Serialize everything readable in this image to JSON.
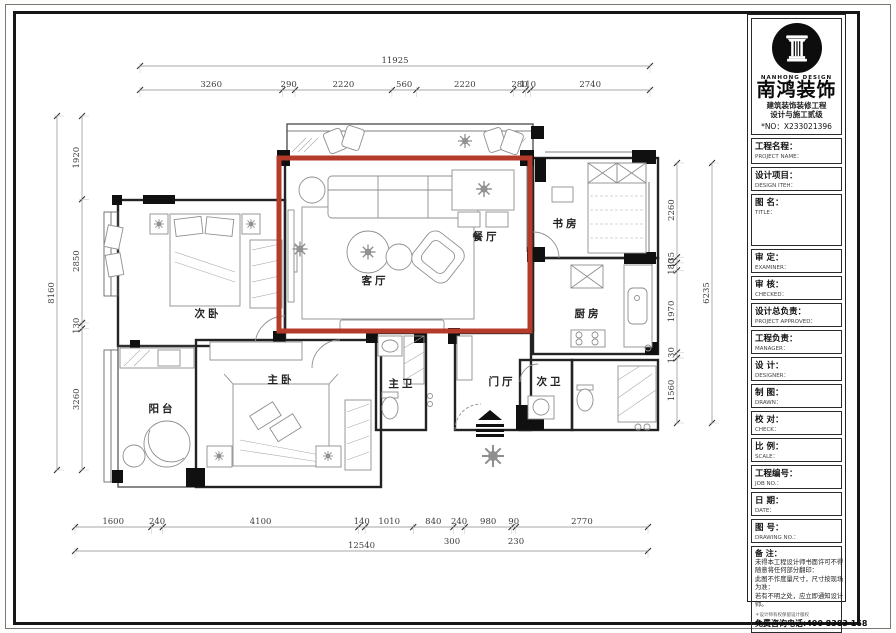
{
  "title_block": {
    "brand_en": "NANHONG DESIGN",
    "brand_cn": "南鸿装饰",
    "cert_line1": "建筑装饰装修工程",
    "cert_line2": "设计与施工贰级",
    "license_no": "*NO：X233021396",
    "fields": [
      {
        "cn": "工程名程：",
        "en": "PROJECT NAME："
      },
      {
        "cn": "设计项目：",
        "en": "DESIGN ITEH："
      },
      {
        "cn": "图 名：",
        "en": "TITLE："
      },
      {
        "cn": "审 定：",
        "en": "EXAMINER："
      },
      {
        "cn": "审 核：",
        "en": "CHECKED："
      },
      {
        "cn": "设计总负责：",
        "en": "PROJECT APPROVED："
      },
      {
        "cn": "工程负责：",
        "en": "MANAGER："
      },
      {
        "cn": "设 计：",
        "en": "DESIGNER："
      },
      {
        "cn": "制 图：",
        "en": "DRAWN："
      },
      {
        "cn": "校 对：",
        "en": "CHECK："
      },
      {
        "cn": "比 例：",
        "en": "SCALE："
      },
      {
        "cn": "工程编号：",
        "en": "JOB NO.："
      },
      {
        "cn": "日 期：",
        "en": "DATE："
      },
      {
        "cn": "图 号：",
        "en": "DRAWING NO.："
      }
    ],
    "notes_title": "备 注：",
    "notes": [
      "未得本工程设计师书面许可不得",
      "随意将任何部分翻印：",
      "此图不作度量尺寸，尺寸按现场",
      "为准：",
      "若有不明之处，应立即通知设计",
      "师。"
    ],
    "notes_small": "＊设计师有权保留设计版权",
    "phone": "免费咨询电话:400 8383 168"
  },
  "rooms": {
    "living": "客厅",
    "dining": "餐厅",
    "study": "书房",
    "bedroom2": "次卧",
    "kitchen": "厨房",
    "balcony": "阳台",
    "master": "主卧",
    "master_bath": "主卫",
    "foyer": "门厅",
    "bath2": "次卫"
  },
  "dimensions": [
    {
      "name": "dim-top-overall",
      "orient": "h",
      "at": 66,
      "from": 140,
      "to": 650,
      "values": [
        11925
      ]
    },
    {
      "name": "dim-top-segments",
      "orient": "h",
      "at": 90,
      "from": 140,
      "to": 650,
      "values": [
        3260,
        290,
        2220,
        560,
        2220,
        280,
        110,
        2740
      ]
    },
    {
      "name": "dim-left-overall",
      "orient": "v",
      "at": 57,
      "from": 116,
      "to": 470,
      "values": [
        8160
      ]
    },
    {
      "name": "dim-left-segments",
      "orient": "v",
      "at": 82,
      "from": 116,
      "to": 470,
      "values": [
        1920,
        2850,
        130,
        3260
      ]
    },
    {
      "name": "dim-right-segments",
      "orient": "v",
      "at": 677,
      "from": 163,
      "to": 423,
      "values": [
        2260,
        135,
        180,
        1970,
        130,
        1560
      ]
    },
    {
      "name": "dim-right-overall",
      "orient": "v",
      "at": 712,
      "from": 163,
      "to": 423,
      "values": [
        6235
      ]
    },
    {
      "name": "dim-bottom-segments",
      "orient": "h",
      "at": 527,
      "from": 75,
      "to": 648,
      "values": [
        1600,
        240,
        4100,
        140,
        1010,
        840,
        240,
        980,
        90,
        2770
      ]
    },
    {
      "name": "dim-bottom-overall",
      "orient": "h",
      "at": 551,
      "from": 75,
      "to": 648,
      "values": [
        12540
      ]
    }
  ],
  "extra_dim_labels": [
    {
      "text": "300",
      "x": 452,
      "y": 544
    },
    {
      "text": "230",
      "x": 516,
      "y": 544
    }
  ]
}
